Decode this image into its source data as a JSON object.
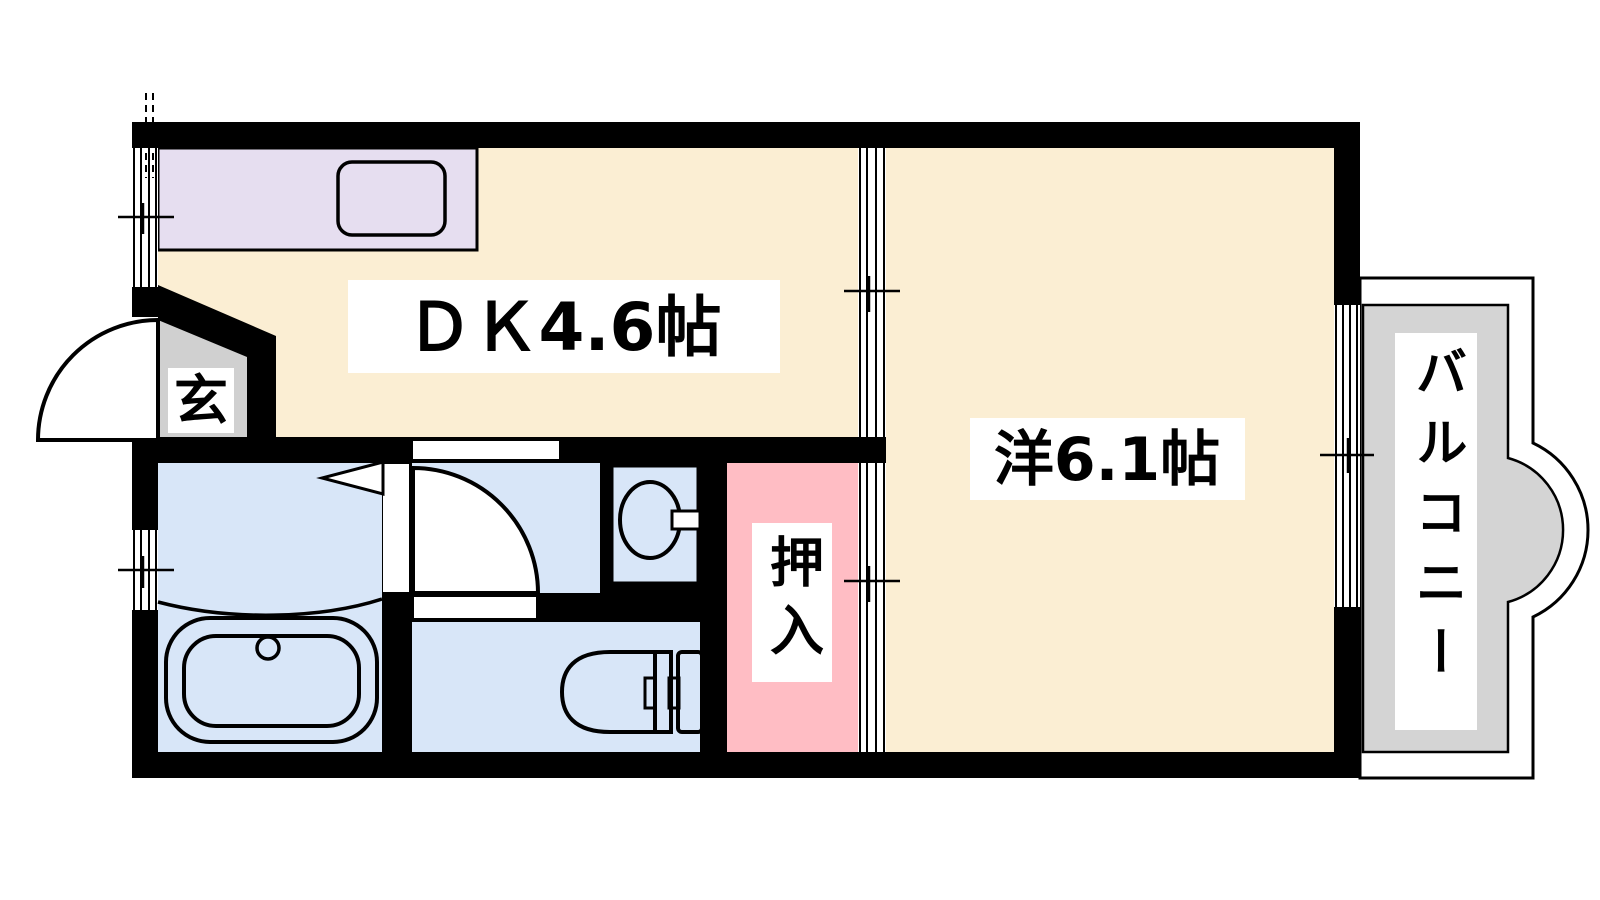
{
  "floor_plan": {
    "rooms": {
      "dining_kitchen": {
        "label": "ＤＫ4.6帖"
      },
      "western_room": {
        "label": "洋6.1帖"
      },
      "entrance": {
        "label": "玄"
      },
      "closet": {
        "label": "押入"
      },
      "balcony": {
        "label": "バルコニー"
      }
    },
    "colors": {
      "room_cream": "#FBEED3",
      "kitchen_counter": "#E6DEF0",
      "wet_area_blue": "#D8E6F8",
      "closet_pink": "#FFBDC4",
      "balcony_gray": "#D4D4D4",
      "entrance_gray": "#D0D0D0",
      "wall": "#000000",
      "label_bg": "#FFFFFF",
      "background": "#FFFFFF"
    }
  }
}
